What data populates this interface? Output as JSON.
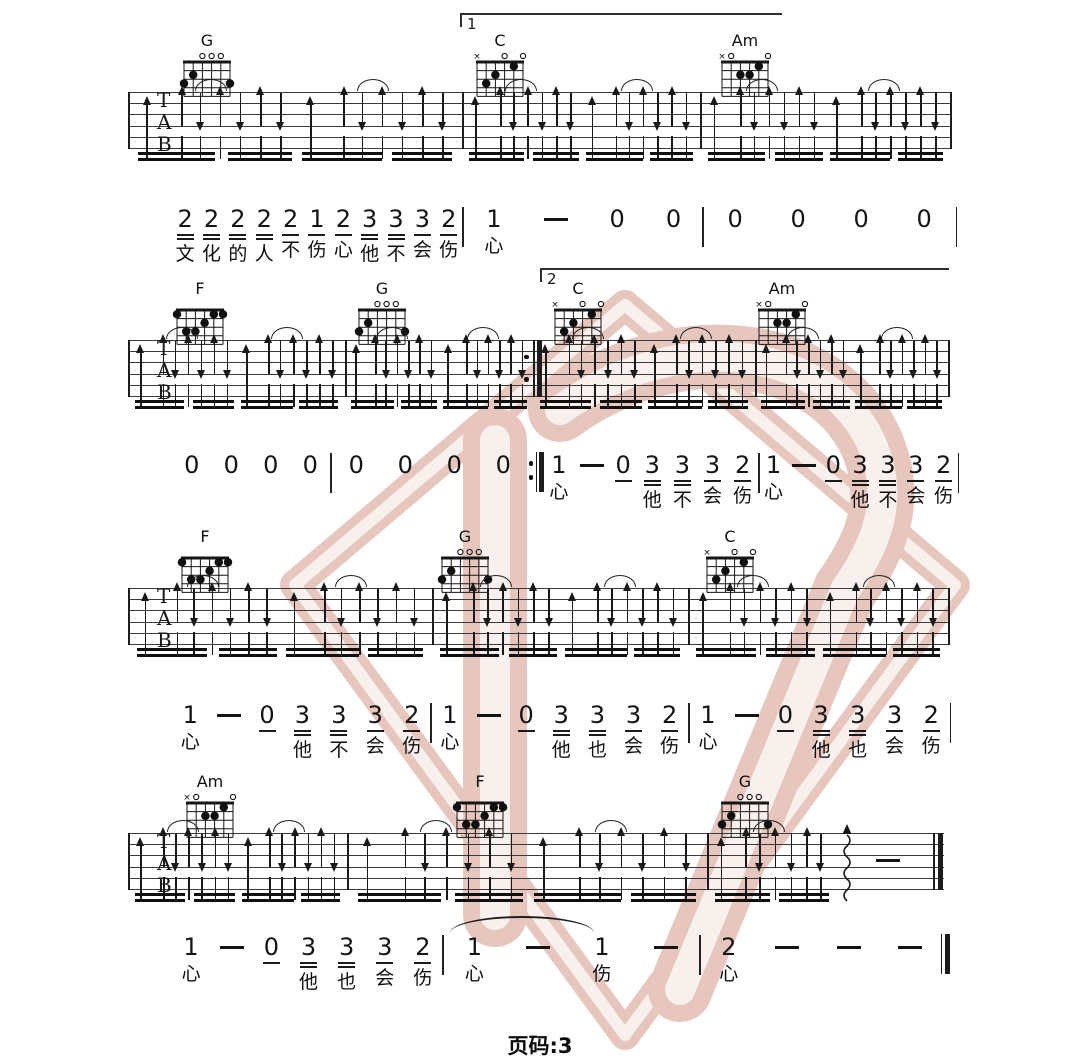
{
  "page": {
    "footer_label": "页码:3",
    "page_number": "3",
    "ink": "#1a1a1a",
    "watermark_color": "#d9a496",
    "watermark_light": "#f4e7e1"
  },
  "staff": {
    "labels": [
      "T",
      "A",
      "B"
    ],
    "line_count": 6,
    "line_gap": 11.2
  },
  "chord_shapes": {
    "G": {
      "markers": [
        "",
        "",
        "o",
        "o",
        "o",
        ""
      ],
      "dots": [
        [
          6,
          3
        ],
        [
          5,
          2
        ],
        [
          1,
          3
        ]
      ]
    },
    "C": {
      "markers": [
        "x",
        "",
        "",
        "o",
        "",
        "o"
      ],
      "dots": [
        [
          5,
          3
        ],
        [
          4,
          2
        ],
        [
          2,
          1
        ]
      ]
    },
    "Am": {
      "markers": [
        "x",
        "o",
        "",
        "",
        "",
        "o"
      ],
      "dots": [
        [
          4,
          2
        ],
        [
          3,
          2
        ],
        [
          2,
          1
        ]
      ]
    },
    "F": {
      "markers": [
        "",
        "",
        "",
        "",
        "",
        ""
      ],
      "dots": [
        [
          6,
          1
        ],
        [
          2,
          1
        ],
        [
          1,
          1
        ],
        [
          3,
          2
        ],
        [
          5,
          3
        ],
        [
          4,
          3
        ]
      ]
    }
  },
  "strum": {
    "full": {
      "arrows": [
        [
          0.055,
          "bass"
        ],
        [
          0.16,
          "up"
        ],
        [
          0.215,
          "down"
        ],
        [
          0.275,
          "up"
        ],
        [
          0.335,
          "down"
        ],
        [
          0.395,
          "up"
        ],
        [
          0.455,
          "down"
        ],
        [
          0.545,
          "bass"
        ],
        [
          0.645,
          "up"
        ],
        [
          0.7,
          "down"
        ],
        [
          0.76,
          "up"
        ],
        [
          0.82,
          "down"
        ],
        [
          0.88,
          "up"
        ],
        [
          0.94,
          "down"
        ]
      ],
      "arcs": [
        0.245,
        0.73
      ],
      "beams": [
        [
          0.03,
          0.26
        ],
        [
          0.3,
          0.49
        ],
        [
          0.52,
          0.76
        ],
        [
          0.79,
          0.97
        ]
      ]
    },
    "end": {
      "arrows": [
        [
          0.06,
          "bass"
        ],
        [
          0.17,
          "up"
        ],
        [
          0.23,
          "down"
        ],
        [
          0.3,
          "up"
        ],
        [
          0.37,
          "down"
        ],
        [
          0.44,
          "up"
        ],
        [
          0.5,
          "down"
        ],
        [
          0.62,
          "wavy"
        ],
        [
          0.8,
          "dash"
        ]
      ],
      "arcs": [
        0.27
      ],
      "beams": [
        [
          0.035,
          0.28
        ],
        [
          0.32,
          0.54
        ]
      ]
    }
  },
  "systems": [
    {
      "staff_top": 92,
      "x1": 128,
      "x2": 950,
      "right": "thin",
      "volta": {
        "label": "1",
        "x1": 460,
        "x2": 780,
        "y": 13
      },
      "chords": [
        {
          "name": "G",
          "x": 207
        },
        {
          "name": "C",
          "x": 500
        },
        {
          "name": "Am",
          "x": 745
        }
      ],
      "barlines": [
        462,
        700
      ],
      "measures": [
        [
          128,
          462,
          "full"
        ],
        [
          462,
          700,
          "full"
        ],
        [
          700,
          950,
          "full"
        ]
      ]
    },
    {
      "staff_top": 340,
      "x1": 128,
      "x2": 948,
      "right": "thin",
      "volta": {
        "label": "2",
        "x1": 540,
        "x2": 947,
        "y": 268
      },
      "chords": [
        {
          "name": "F",
          "x": 200
        },
        {
          "name": "G",
          "x": 382
        },
        {
          "name": "C",
          "x": 578
        },
        {
          "name": "Am",
          "x": 782
        }
      ],
      "barlines": [
        345,
        755
      ],
      "repeat_end": 533,
      "measures": [
        [
          128,
          345,
          "full"
        ],
        [
          345,
          533,
          "full"
        ],
        [
          533,
          755,
          "full"
        ],
        [
          755,
          948,
          "full"
        ]
      ]
    },
    {
      "staff_top": 588,
      "x1": 128,
      "x2": 948,
      "right": "thin",
      "chords": [
        {
          "name": "F",
          "x": 205
        },
        {
          "name": "G",
          "x": 465
        },
        {
          "name": "C",
          "x": 730
        }
      ],
      "barlines": [
        432,
        688
      ],
      "measures": [
        [
          128,
          432,
          "full"
        ],
        [
          432,
          688,
          "full"
        ],
        [
          688,
          948,
          "full"
        ]
      ]
    },
    {
      "staff_top": 833,
      "x1": 128,
      "x2": 944,
      "right": "final",
      "chords": [
        {
          "name": "Am",
          "x": 210
        },
        {
          "name": "F",
          "x": 480
        },
        {
          "name": "G",
          "x": 745
        }
      ],
      "barlines": [
        347,
        707
      ],
      "measures": [
        [
          128,
          347,
          "full"
        ],
        [
          347,
          707,
          "full"
        ],
        [
          707,
          933,
          "end"
        ]
      ]
    }
  ],
  "notation_lines": [
    {
      "top": 206,
      "x1": 172,
      "end": "bar",
      "measures": [
        {
          "w": 290,
          "tokens": [
            [
              "2",
              2,
              "文"
            ],
            [
              "2",
              2,
              "化"
            ],
            [
              "2",
              2,
              "的"
            ],
            [
              "2",
              2,
              "人"
            ],
            [
              "2",
              1,
              "不"
            ],
            [
              "1",
              1,
              "伤"
            ],
            [
              "2",
              1,
              "心"
            ],
            [
              "3",
              2,
              "他"
            ],
            [
              "3",
              2,
              "不"
            ],
            [
              "3",
              1,
              "会"
            ],
            [
              "2",
              1,
              "伤"
            ]
          ]
        },
        {
          "w": 238,
          "tokens": [
            [
              "1",
              0,
              "心"
            ],
            [
              "-",
              0,
              ""
            ],
            [
              "0",
              0,
              ""
            ],
            [
              "0",
              0,
              ""
            ]
          ]
        },
        {
          "w": 252,
          "tokens": [
            [
              "0",
              0,
              ""
            ],
            [
              "0",
              0,
              ""
            ],
            [
              "0",
              0,
              ""
            ],
            [
              "0",
              0,
              ""
            ]
          ]
        }
      ]
    },
    {
      "top": 452,
      "x1": 172,
      "end": "bar",
      "measures": [
        {
          "w": 158,
          "tokens": [
            [
              "0",
              0,
              ""
            ],
            [
              "0",
              0,
              ""
            ],
            [
              "0",
              0,
              ""
            ],
            [
              "0",
              0,
              ""
            ]
          ]
        },
        {
          "w": 196,
          "end": "repeat",
          "tokens": [
            [
              "0",
              0,
              ""
            ],
            [
              "0",
              0,
              ""
            ],
            [
              "0",
              0,
              ""
            ],
            [
              "0",
              0,
              ""
            ]
          ]
        },
        {
          "w": 214,
          "tokens": [
            [
              "1",
              0,
              "心"
            ],
            [
              "-",
              0,
              ""
            ],
            [
              "0",
              1,
              ""
            ],
            [
              "3",
              2,
              "他"
            ],
            [
              "3",
              2,
              "不"
            ],
            [
              "3",
              1,
              "会"
            ],
            [
              "2",
              1,
              "伤"
            ]
          ]
        },
        {
          "w": 198,
          "tokens": [
            [
              "1",
              0,
              "心"
            ],
            [
              "-",
              0,
              ""
            ],
            [
              "0",
              1,
              ""
            ],
            [
              "3",
              2,
              "他"
            ],
            [
              "3",
              2,
              "不"
            ],
            [
              "3",
              1,
              "会"
            ],
            [
              "2",
              1,
              "伤"
            ]
          ]
        }
      ]
    },
    {
      "top": 702,
      "x1": 172,
      "end": "bar",
      "measures": [
        {
          "w": 258,
          "tokens": [
            [
              "1",
              0,
              "心"
            ],
            [
              "-",
              0,
              ""
            ],
            [
              "0",
              1,
              ""
            ],
            [
              "3",
              2,
              "他"
            ],
            [
              "3",
              2,
              "不"
            ],
            [
              "3",
              1,
              "会"
            ],
            [
              "2",
              1,
              "伤"
            ]
          ]
        },
        {
          "w": 256,
          "tokens": [
            [
              "1",
              0,
              "心"
            ],
            [
              "-",
              0,
              ""
            ],
            [
              "0",
              1,
              ""
            ],
            [
              "3",
              2,
              "他"
            ],
            [
              "3",
              2,
              "也"
            ],
            [
              "3",
              1,
              "会"
            ],
            [
              "2",
              1,
              "伤"
            ]
          ]
        },
        {
          "w": 260,
          "tokens": [
            [
              "1",
              0,
              "心"
            ],
            [
              "-",
              0,
              ""
            ],
            [
              "0",
              1,
              ""
            ],
            [
              "3",
              2,
              "他"
            ],
            [
              "3",
              2,
              "也"
            ],
            [
              "3",
              1,
              "会"
            ],
            [
              "2",
              1,
              "伤"
            ]
          ]
        }
      ]
    },
    {
      "top": 934,
      "x1": 172,
      "end": "final",
      "arc": {
        "x1": 450,
        "x2": 594,
        "y": 916
      },
      "measures": [
        {
          "w": 270,
          "tokens": [
            [
              "1",
              0,
              "心"
            ],
            [
              "-",
              0,
              ""
            ],
            [
              "0",
              1,
              ""
            ],
            [
              "3",
              2,
              "他"
            ],
            [
              "3",
              2,
              "也"
            ],
            [
              "3",
              1,
              "会"
            ],
            [
              "2",
              1,
              "伤"
            ]
          ]
        },
        {
          "w": 255,
          "tokens": [
            [
              "1",
              0,
              "心"
            ],
            [
              "-",
              0,
              ""
            ],
            [
              "1",
              0,
              "伤"
            ],
            [
              "-",
              0,
              ""
            ]
          ]
        },
        {
          "w": 240,
          "tokens": [
            [
              "2",
              0,
              "心"
            ],
            [
              "-",
              0,
              ""
            ],
            [
              "-",
              0,
              ""
            ],
            [
              "-",
              0,
              ""
            ]
          ]
        }
      ]
    }
  ]
}
